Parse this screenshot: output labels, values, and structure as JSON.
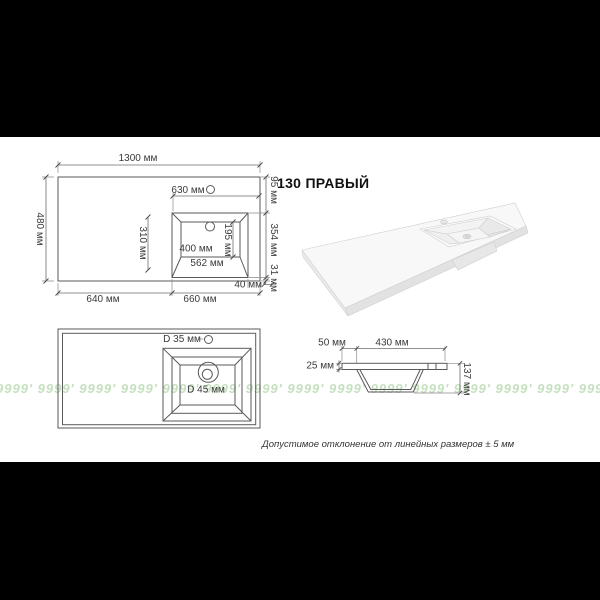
{
  "title": "130 ПРАВЫЙ",
  "note": "Допустимое отклонение от линейных размеров ± 5 мм",
  "watermark": {
    "unit": "9999'",
    "repeat": 16,
    "color_hex": "#96c78c",
    "opacity": 0.55
  },
  "top_view": {
    "overall_width": "1300 мм",
    "overall_depth": "480 мм",
    "basin_to_right_edge": "630 мм",
    "edge_to_basin": "95 мм",
    "basin_inner_depth": "310 мм",
    "drain_to_edge": "195 мм",
    "basin_bottom_width": "400 мм",
    "basin_top_width": "562 мм",
    "basin_span": "354 мм",
    "basin_to_bottom_edge": "31 мм",
    "basin_side_gap": "40 мм",
    "left_section": "640 мм",
    "right_section": "660 мм"
  },
  "holes_view": {
    "faucet_hole": "D 35 мм",
    "drain_hole": "D 45 мм"
  },
  "section_view": {
    "rim_offset": "50 мм",
    "bowl_width": "430 мм",
    "board_thickness": "25 мм",
    "bowl_depth": "137 мм"
  }
}
